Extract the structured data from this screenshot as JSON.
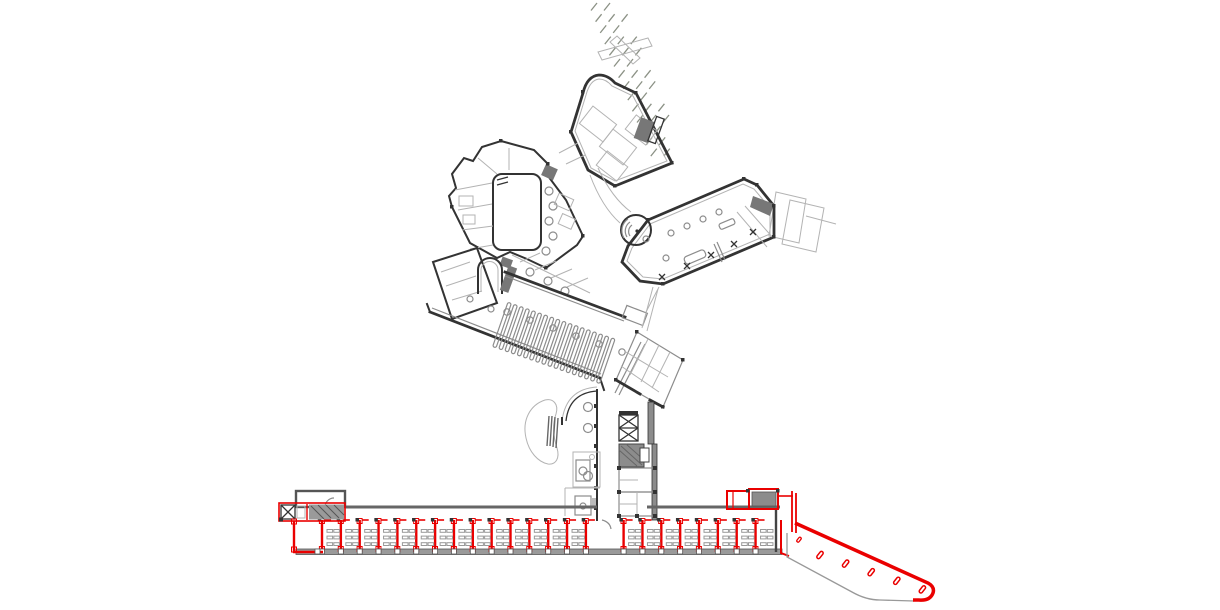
{
  "drawing": {
    "kind": "architectural-floor-plan",
    "visible_text": "none"
  },
  "colors": {
    "background": "#ffffff",
    "wall_dark": "#333333",
    "wall_mid": "#8c8c8c",
    "detail_light": "#b3b3b3",
    "accent_red": "#ea0000",
    "terrain_olive": "#8b9185",
    "poche_hatch": "#777777",
    "strip_gray": "#9a9a9a"
  },
  "terrain_hatch": {
    "row_counts": [
      2,
      3,
      2,
      3,
      3,
      2,
      3,
      3,
      2,
      3,
      3,
      2,
      2,
      2
    ],
    "start_x": 591,
    "start_y": 8,
    "row_step_y": 11.2,
    "row_drift_x": 4.6,
    "dash_gap_x": 13,
    "dash_dx": 6,
    "dash_dy": -5
  },
  "library_stacks": {
    "count": 18,
    "start_cx": 502,
    "start_cy": 325,
    "step_x": 6.1,
    "step_y": 2.1,
    "bar_w": 3.6,
    "bar_h": 47,
    "angle_deg": 19
  },
  "library_columns": {
    "count": 6,
    "start_x": 507,
    "start_y": 312,
    "step_x": 23,
    "step_y": 8,
    "radius": 3.2
  },
  "bottom_wing": {
    "partition_count": 24,
    "skip_partition_index": 15,
    "start_x": 322,
    "step_x": 18.85,
    "top_y": 520,
    "bottom_y": 552.5,
    "skip_shelf_bays": [
      14,
      15
    ],
    "shelf_rows": 3,
    "shelf_cols": 2,
    "strip_x1": 296,
    "strip_x2": 782,
    "strip_y": 549,
    "strip_h": 5.5,
    "wall_y": 507,
    "wall_segments": [
      [
        345,
        597
      ],
      [
        647,
        780
      ]
    ]
  },
  "ramp": {
    "slot_count": 5,
    "slot_start_x": 820,
    "slot_start_y": 555,
    "slot_step_x": 25.6,
    "slot_step_y": 8.6,
    "slot_w": 3.4,
    "slot_h": 8.2,
    "slot_angle_deg": 38
  }
}
